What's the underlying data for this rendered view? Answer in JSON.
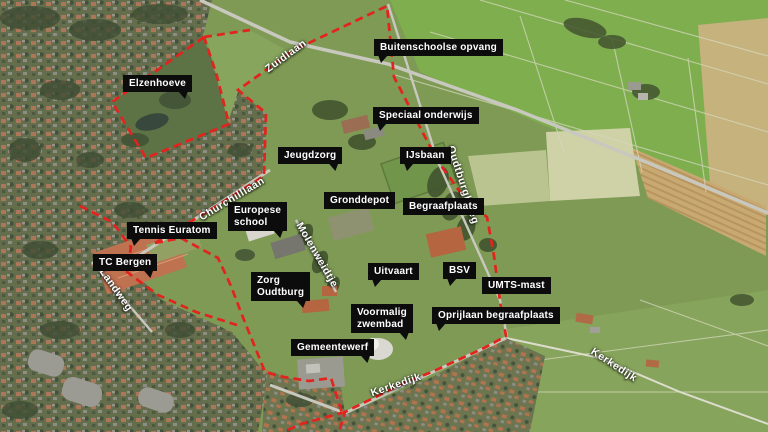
{
  "map": {
    "boundary_color": "#e3231d",
    "label_bg": "#0c0c0c",
    "label_text": "#ffffff",
    "road_label_color": "#ffffff",
    "place_labels": [
      {
        "text": "Elzenhoeve",
        "x": 123,
        "y": 75,
        "tail": "br"
      },
      {
        "text": "Buitenschoolse opvang",
        "x": 374,
        "y": 39,
        "tail": "bl"
      },
      {
        "text": "Speciaal onderwijs",
        "x": 373,
        "y": 107,
        "tail": "bl"
      },
      {
        "text": "Jeugdzorg",
        "x": 278,
        "y": 147,
        "tail": "br"
      },
      {
        "text": "IJsbaan",
        "x": 400,
        "y": 147,
        "tail": "bl"
      },
      {
        "text": "Gronddepot",
        "x": 324,
        "y": 192,
        "tail": "none"
      },
      {
        "text": "Begraafplaats",
        "x": 403,
        "y": 198,
        "tail": "none"
      },
      {
        "text": "Europese\nschool",
        "x": 228,
        "y": 202,
        "tail": "br"
      },
      {
        "text": "Tennis Euratom",
        "x": 127,
        "y": 222,
        "tail": "bl"
      },
      {
        "text": "TC Bergen",
        "x": 93,
        "y": 254,
        "tail": "br"
      },
      {
        "text": "Zorg\nOudtburg",
        "x": 251,
        "y": 272,
        "tail": "br"
      },
      {
        "text": "Uitvaart",
        "x": 368,
        "y": 263,
        "tail": "bl"
      },
      {
        "text": "BSV",
        "x": 443,
        "y": 262,
        "tail": "bl"
      },
      {
        "text": "UMTS-mast",
        "x": 482,
        "y": 277,
        "tail": "none"
      },
      {
        "text": "Voormalig\nzwembad",
        "x": 351,
        "y": 304,
        "tail": "br"
      },
      {
        "text": "Oprijlaan begraafplaats",
        "x": 432,
        "y": 307,
        "tail": "bl"
      },
      {
        "text": "Gemeentewerf",
        "x": 291,
        "y": 339,
        "tail": "br"
      }
    ],
    "road_labels": [
      {
        "text": "Zuidlaan",
        "x": 286,
        "y": 56,
        "rot": -36
      },
      {
        "text": "Churchilllaan",
        "x": 232,
        "y": 199,
        "rot": -31
      },
      {
        "text": "Oudtburghweg",
        "x": 463,
        "y": 185,
        "rot": 72
      },
      {
        "text": "Molenweidtje",
        "x": 317,
        "y": 255,
        "rot": 60
      },
      {
        "text": "Landweg",
        "x": 116,
        "y": 290,
        "rot": 55
      },
      {
        "text": "Kerkedijk",
        "x": 396,
        "y": 385,
        "rot": -19
      },
      {
        "text": "Kerkedijk",
        "x": 614,
        "y": 365,
        "rot": 33
      }
    ]
  }
}
